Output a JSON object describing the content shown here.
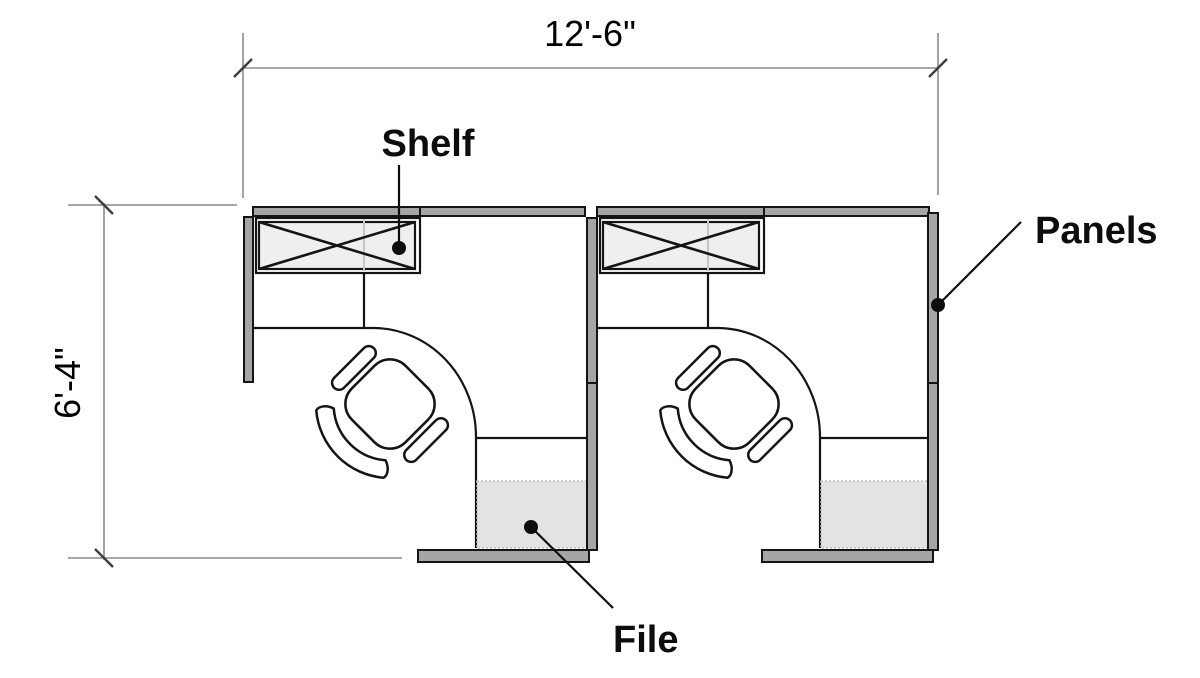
{
  "plan": {
    "type": "office-cubicle-floor-plan",
    "workstation_count": 2,
    "width_dimension": "12'-6\"",
    "depth_dimension": "6'-4\"",
    "callouts": [
      {
        "id": "shelf",
        "label": "Shelf"
      },
      {
        "id": "panels",
        "label": "Panels"
      },
      {
        "id": "file",
        "label": "File"
      }
    ],
    "components_per_workstation": [
      "shelf",
      "corner-desk",
      "task-chair",
      "file-cabinet",
      "panels"
    ],
    "colors": {
      "panel_fill": "#a5a5a5",
      "shelf_fill": "#eeeeee",
      "file_fill": "#e3e3e3",
      "dim_line": "#8a8a8a",
      "line": "#141414"
    }
  }
}
